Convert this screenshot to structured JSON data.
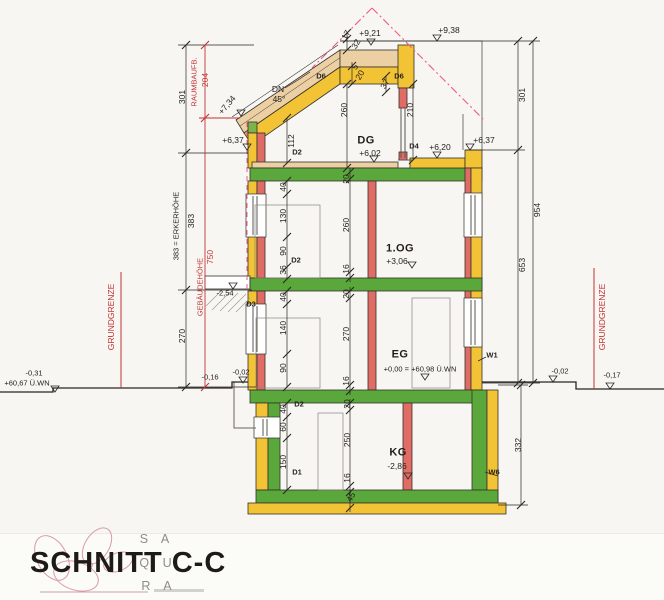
{
  "t": {
    "title": "SCHNITT C-C",
    "logo1": "S A",
    "logo2": "Q U",
    "logo3": "R A",
    "dg": "DG",
    "og": "1.OG",
    "eg": "EG",
    "kg": "KG",
    "l938": "+9,38",
    "l921": "+9,21",
    "l734": "+7,34",
    "l637l": "+6,37",
    "l637r": "+6,37",
    "l620": "+6,20",
    "l602": "+6,02",
    "l306": "+3,06",
    "l000": "+0,00 = +60,98 Ü.WN",
    "l286": "-2,86",
    "l254": "-2,54",
    "l002l": "-0,02",
    "l016": "-0,16",
    "l031": "-0,31",
    "l6067": "+60,67 Ü.WN",
    "l002r": "-0,02",
    "l017": "-0,17",
    "d1": "D1",
    "d2dg": "D2",
    "d2og": "D2",
    "d2kg": "D2",
    "d3": "D3",
    "d4": "D4",
    "d6l": "D6",
    "d6r": "D6",
    "w1": "W1",
    "w6": "W6",
    "dn": "DN",
    "dn45": "45°",
    "grenzl": "GRUNDGRENZE",
    "grenzr": "GRUNDGRENZE",
    "raumb": "RAUMBAUFB.",
    "raumbval": "204",
    "geb": "GEBÄUDEHÖHE",
    "gebval": "750",
    "dim301l": "301",
    "dim383txt": "383 = ERKERHÖHE",
    "dim383": "383",
    "dim270l": "270",
    "dim954": "954",
    "dim653": "653",
    "dim301r": "301",
    "dim332": "332",
    "dim112": "112",
    "dim40og": "40",
    "dim130": "130",
    "dim90og": "90",
    "dim36": "36",
    "dim40eg": "40",
    "dim140": "140",
    "dim90eg": "90",
    "dim40kg": "40",
    "dim60": "60",
    "dim150": "150",
    "dim17": "17",
    "dim32": "32",
    "dim5": "5",
    "dim20a": "20",
    "dim260dg": "260",
    "dim210": "210",
    "dim37": "37",
    "dim20og": "20",
    "dim260og": "260",
    "dim16og": "16",
    "dim20eg": "20",
    "dim270eg": "270",
    "dim16eg": "16",
    "dim20kg": "20",
    "dim250": "250",
    "dim16kg": "16",
    "dim45": "45"
  }
}
